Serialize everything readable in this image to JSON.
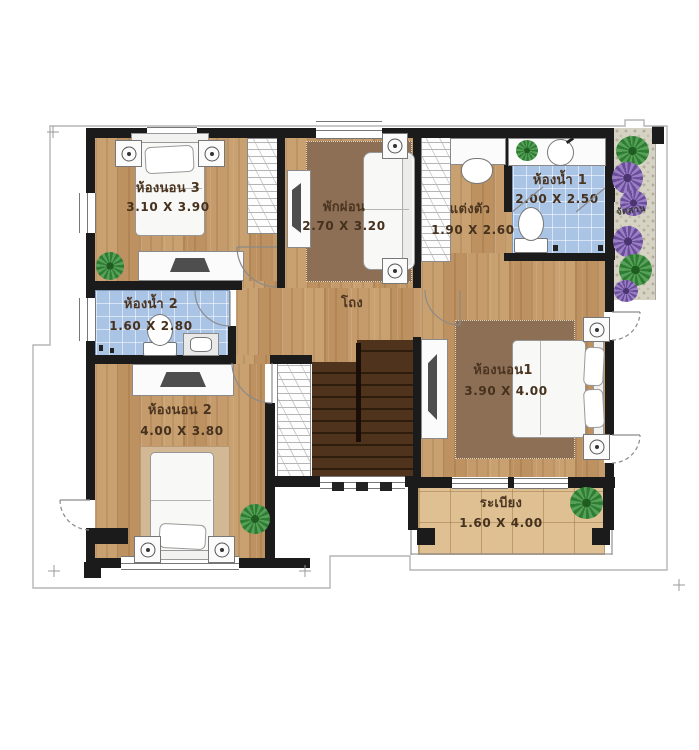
{
  "page": {
    "background": "#ffffff",
    "kind": "second-floor house plan"
  },
  "plan": {
    "colors": {
      "wall": "#1b1b1b",
      "wood_floor": "#c49a6b",
      "bath_tile": "#aac4e6",
      "balcony_tile": "#dec092",
      "rug_dark": "#8d6f55",
      "rug_light": "#d2b894",
      "stairs": "#4a2d18",
      "garden_gravel": "#d7d3c4",
      "plant_green": "#2e7d32",
      "plant_purple": "#6a4e9c"
    },
    "rooms": {
      "bedroom3": {
        "label": "ห้องนอน 3",
        "dims": "3.10 X 3.90"
      },
      "lounge": {
        "label": "พักผ่อน",
        "dims": "2.70 X 3.20"
      },
      "dressing": {
        "label": "แต่งตัว",
        "dims": "1.90 X 2.60"
      },
      "bathroom1": {
        "label": "ห้องน้ำ 1",
        "dims": "2.00 X 2.50"
      },
      "bathroom2": {
        "label": "ห้องน้ำ 2",
        "dims": "1.60 X 2.80"
      },
      "hall": {
        "label": "โถง"
      },
      "bedroom1": {
        "label": "ห้องนอน1",
        "dims": "3.90 X 4.00"
      },
      "bedroom2": {
        "label": "ห้องนอน 2",
        "dims": "4.00 X 3.80"
      },
      "balcony": {
        "label": "ระเบียง",
        "dims": "1.60 X 4.00"
      },
      "garden": {
        "label": "จัดสวน"
      }
    }
  }
}
